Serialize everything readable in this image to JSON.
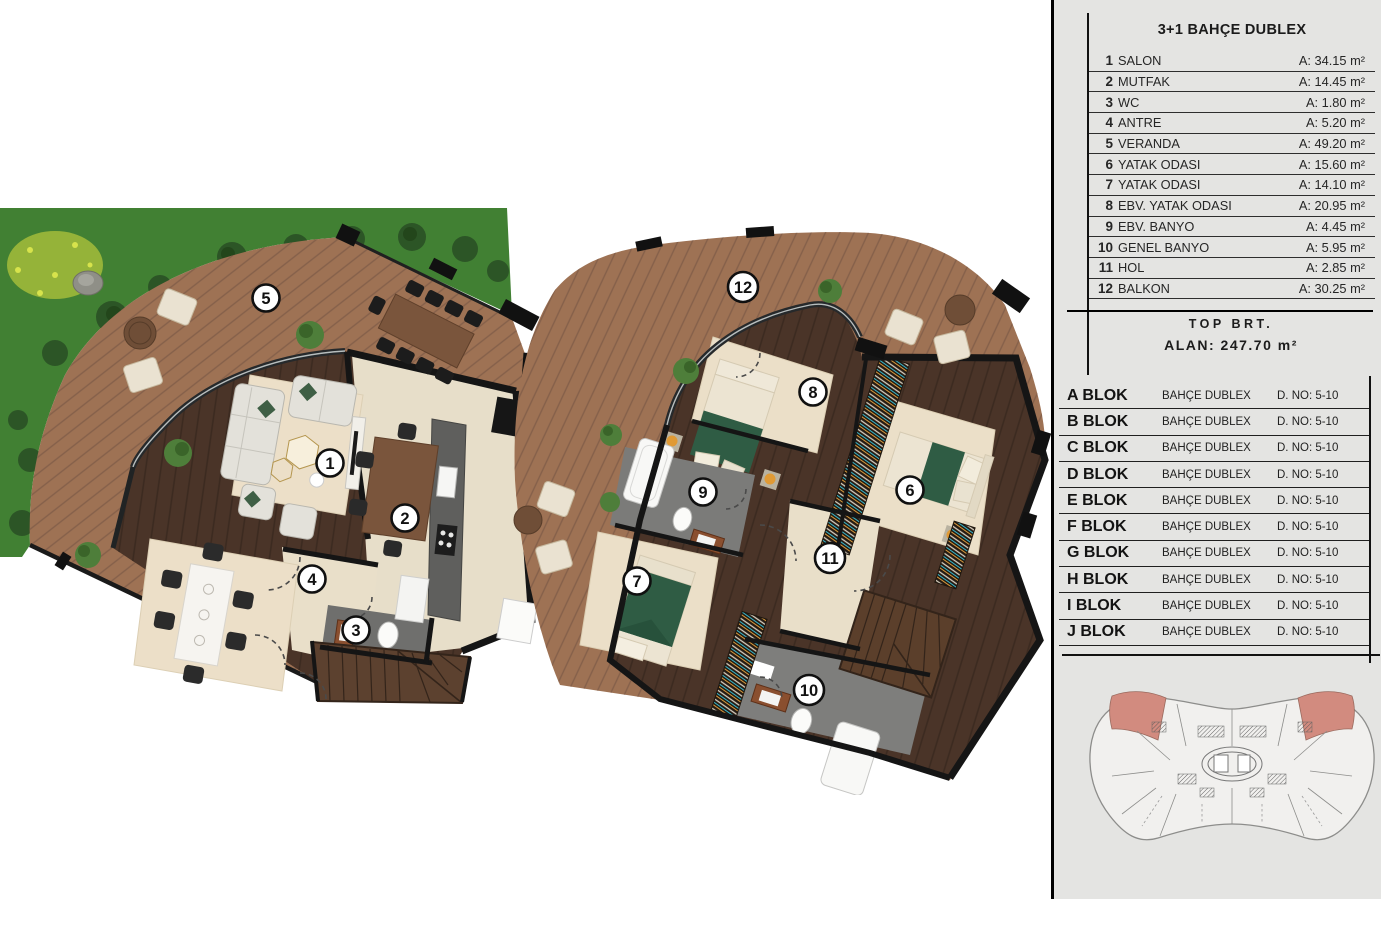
{
  "legend": {
    "title": "3+1 BAHÇE DUBLEX",
    "rooms": [
      {
        "no": "1",
        "name": "SALON",
        "area": "A: 34.15 m²"
      },
      {
        "no": "2",
        "name": "MUTFAK",
        "area": "A: 14.45 m²"
      },
      {
        "no": "3",
        "name": "WC",
        "area": "A: 1.80 m²"
      },
      {
        "no": "4",
        "name": "ANTRE",
        "area": "A: 5.20 m²"
      },
      {
        "no": "5",
        "name": "VERANDA",
        "area": "A: 49.20 m²"
      },
      {
        "no": "6",
        "name": "YATAK ODASI",
        "area": "A: 15.60 m²"
      },
      {
        "no": "7",
        "name": "YATAK ODASI",
        "area": "A: 14.10 m²"
      },
      {
        "no": "8",
        "name": "EBV. YATAK ODASI",
        "area": "A: 20.95 m²"
      },
      {
        "no": "9",
        "name": "EBV. BANYO",
        "area": "A: 4.45 m²"
      },
      {
        "no": "10",
        "name": "GENEL BANYO",
        "area": "A: 5.95 m²"
      },
      {
        "no": "11",
        "name": "HOL",
        "area": "A: 2.85 m²"
      },
      {
        "no": "12",
        "name": "BALKON",
        "area": "A: 30.25 m²"
      }
    ],
    "total_line1": "TOP BRT.",
    "total_line2": "ALAN: 247.70 m²"
  },
  "blocks": [
    {
      "name": "A BLOK",
      "type": "BAHÇE DUBLEX",
      "no": "D. NO: 5-10"
    },
    {
      "name": "B BLOK",
      "type": "BAHÇE DUBLEX",
      "no": "D. NO: 5-10"
    },
    {
      "name": "C BLOK",
      "type": "BAHÇE DUBLEX",
      "no": "D. NO: 5-10"
    },
    {
      "name": "D BLOK",
      "type": "BAHÇE DUBLEX",
      "no": "D. NO: 5-10"
    },
    {
      "name": "E BLOK",
      "type": "BAHÇE DUBLEX",
      "no": "D. NO: 5-10"
    },
    {
      "name": "F BLOK",
      "type": "BAHÇE DUBLEX",
      "no": "D. NO: 5-10"
    },
    {
      "name": "G BLOK",
      "type": "BAHÇE DUBLEX",
      "no": "D. NO: 5-10"
    },
    {
      "name": "H BLOK",
      "type": "BAHÇE DUBLEX",
      "no": "D. NO: 5-10"
    },
    {
      "name": "I BLOK",
      "type": "BAHÇE DUBLEX",
      "no": "D. NO: 5-10"
    },
    {
      "name": "J BLOK",
      "type": "BAHÇE DUBLEX",
      "no": "D. NO: 5-10"
    }
  ],
  "plans": {
    "ground": {
      "markers": [
        {
          "no": "5",
          "x": 266,
          "y": 93
        },
        {
          "no": "1",
          "x": 330,
          "y": 258
        },
        {
          "no": "2",
          "x": 405,
          "y": 313
        },
        {
          "no": "4",
          "x": 312,
          "y": 374
        },
        {
          "no": "3",
          "x": 356,
          "y": 425
        }
      ]
    },
    "upper": {
      "markers": [
        {
          "no": "12",
          "x": 245,
          "y": 62
        },
        {
          "no": "8",
          "x": 315,
          "y": 167
        },
        {
          "no": "6",
          "x": 412,
          "y": 265
        },
        {
          "no": "9",
          "x": 205,
          "y": 267
        },
        {
          "no": "11",
          "x": 332,
          "y": 333
        },
        {
          "no": "7",
          "x": 139,
          "y": 356
        },
        {
          "no": "10",
          "x": 311,
          "y": 465
        }
      ]
    }
  },
  "colors": {
    "panel_bg": "#e4e4e2",
    "grass": "#418033",
    "deck_wood": "#9e7254",
    "interior_wood": "#4a3428",
    "rug_cream": "#ebdfc8",
    "bath_gray": "#7b7b79",
    "bed_green": "#2f5c44",
    "wall_black": "#151515",
    "siteplan_highlight": "#d28b7f"
  }
}
